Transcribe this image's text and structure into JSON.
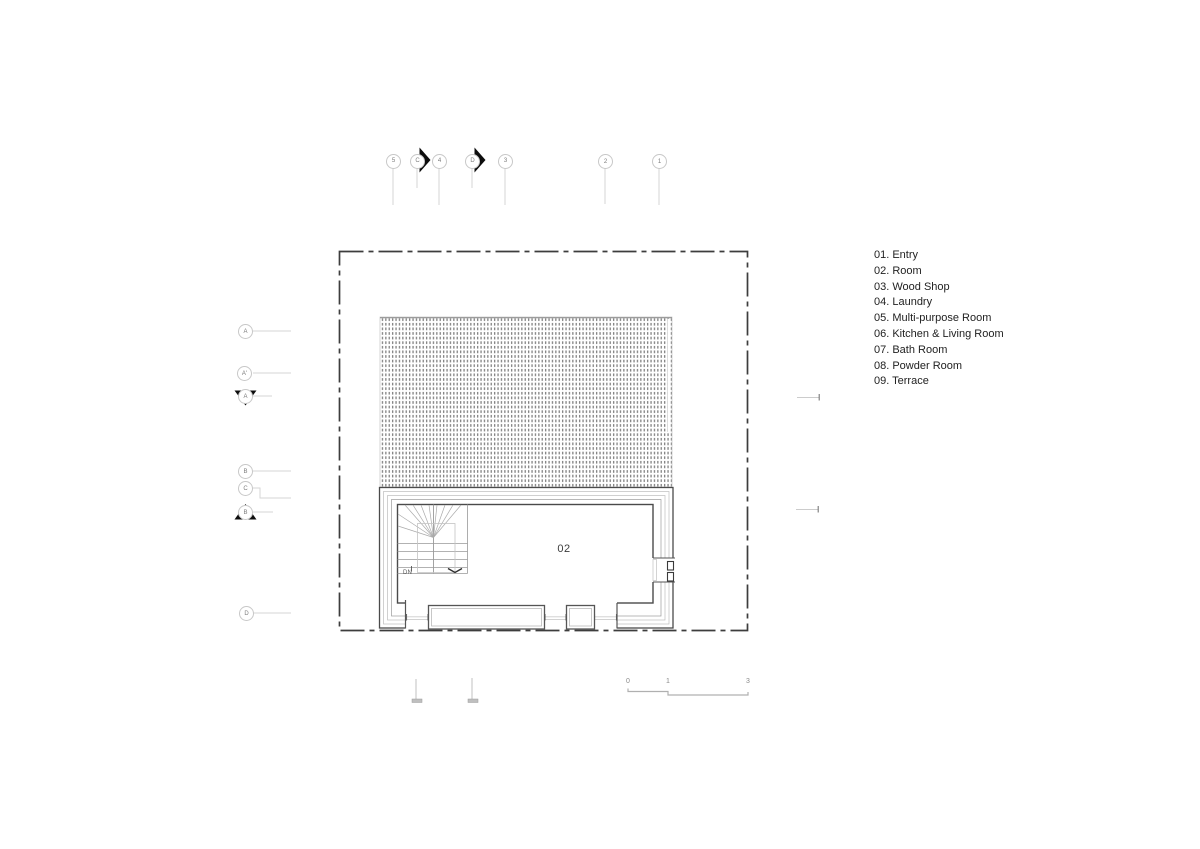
{
  "canvas": {
    "background": "#ffffff"
  },
  "legend": {
    "items": [
      "01. Entry",
      "02. Room",
      "03. Wood Shop",
      "04. Laundry",
      "05. Multi-purpose Room",
      "06. Kitchen & Living Room",
      "07. Bath Room",
      "08. Powder Room",
      "09. Terrace"
    ]
  },
  "plan": {
    "room_label": "02",
    "stair_label": "DN"
  },
  "grid_top": [
    {
      "label": "5"
    },
    {
      "label": "C"
    },
    {
      "label": "4"
    },
    {
      "label": "D"
    },
    {
      "label": "3"
    },
    {
      "label": "2"
    },
    {
      "label": "1"
    }
  ],
  "grid_left": [
    {
      "label": "A"
    },
    {
      "label": "A'"
    },
    {
      "label": "A"
    },
    {
      "label": "B"
    },
    {
      "label": "C"
    },
    {
      "label": "B"
    },
    {
      "label": "D"
    }
  ],
  "scale_bar": {
    "labels": [
      "0",
      "1",
      "3"
    ]
  },
  "colors": {
    "line_dark": "#4a4a4a",
    "line_light": "#bdbdbd",
    "leader": "#d6d6d6",
    "hatch_dot": "#818181",
    "marker_black": "#0d0d0d",
    "text": "#222222"
  }
}
